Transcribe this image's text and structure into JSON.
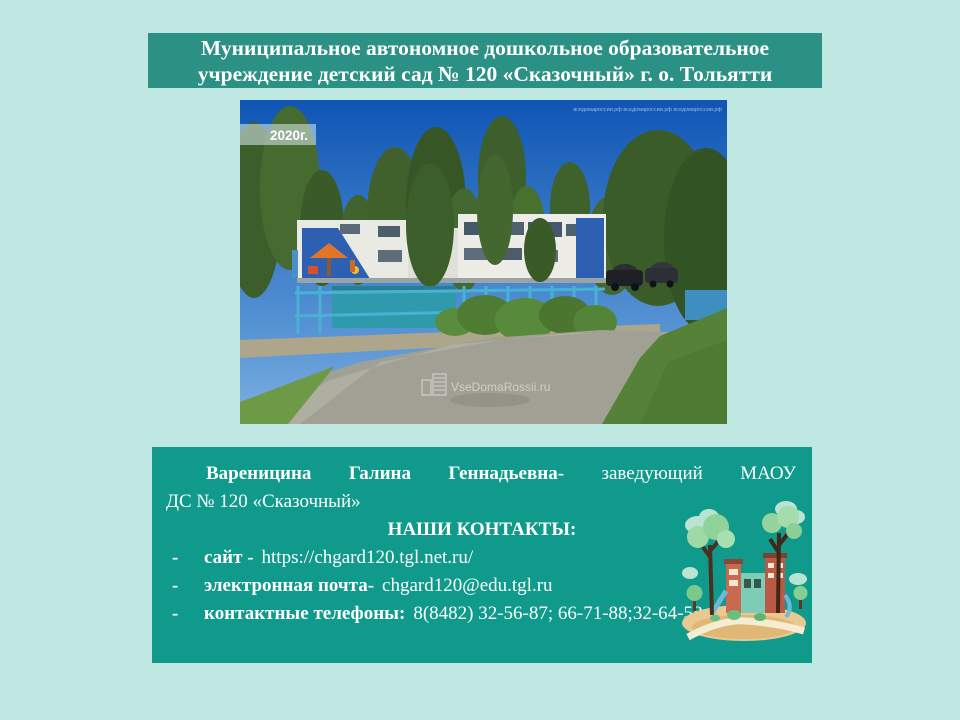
{
  "colors": {
    "page_background": "#c0e8e2",
    "banner_background": "#2b9184",
    "info_box_background": "#109a8c",
    "banner_text": "#ffffff",
    "info_text": "#ffffff"
  },
  "banner": {
    "title": "Муниципальное автономное дошкольное образовательное учреждение детский сад № 120 «Сказочный» г. о. Тольятти"
  },
  "photo": {
    "year_label": "2020г.",
    "watermark_top": "вседомароссии.рф   вседомароссии.рф   вседомароссии.рф",
    "watermark_center": "VseDomaRossii.ru"
  },
  "info_box": {
    "intro": {
      "name_bold": "Вареницина Галина Геннадьевна-",
      "role_line1": "заведующий МАОУ",
      "role_line2": "ДС № 120 «Сказочный»"
    },
    "contacts_heading": "НАШИ КОНТАКТЫ:",
    "contacts": [
      {
        "marker": "-",
        "label": "сайт -",
        "value": "https://chgard120.tgl.net.ru/"
      },
      {
        "marker": "-",
        "label": "электронная почта-",
        "value": "chgard120@edu.tgl.ru"
      },
      {
        "marker": "-",
        "label": "контактные телефоны:",
        "value": "8(8482) 32-56-87; 66-71-88;32-64-58"
      }
    ]
  }
}
